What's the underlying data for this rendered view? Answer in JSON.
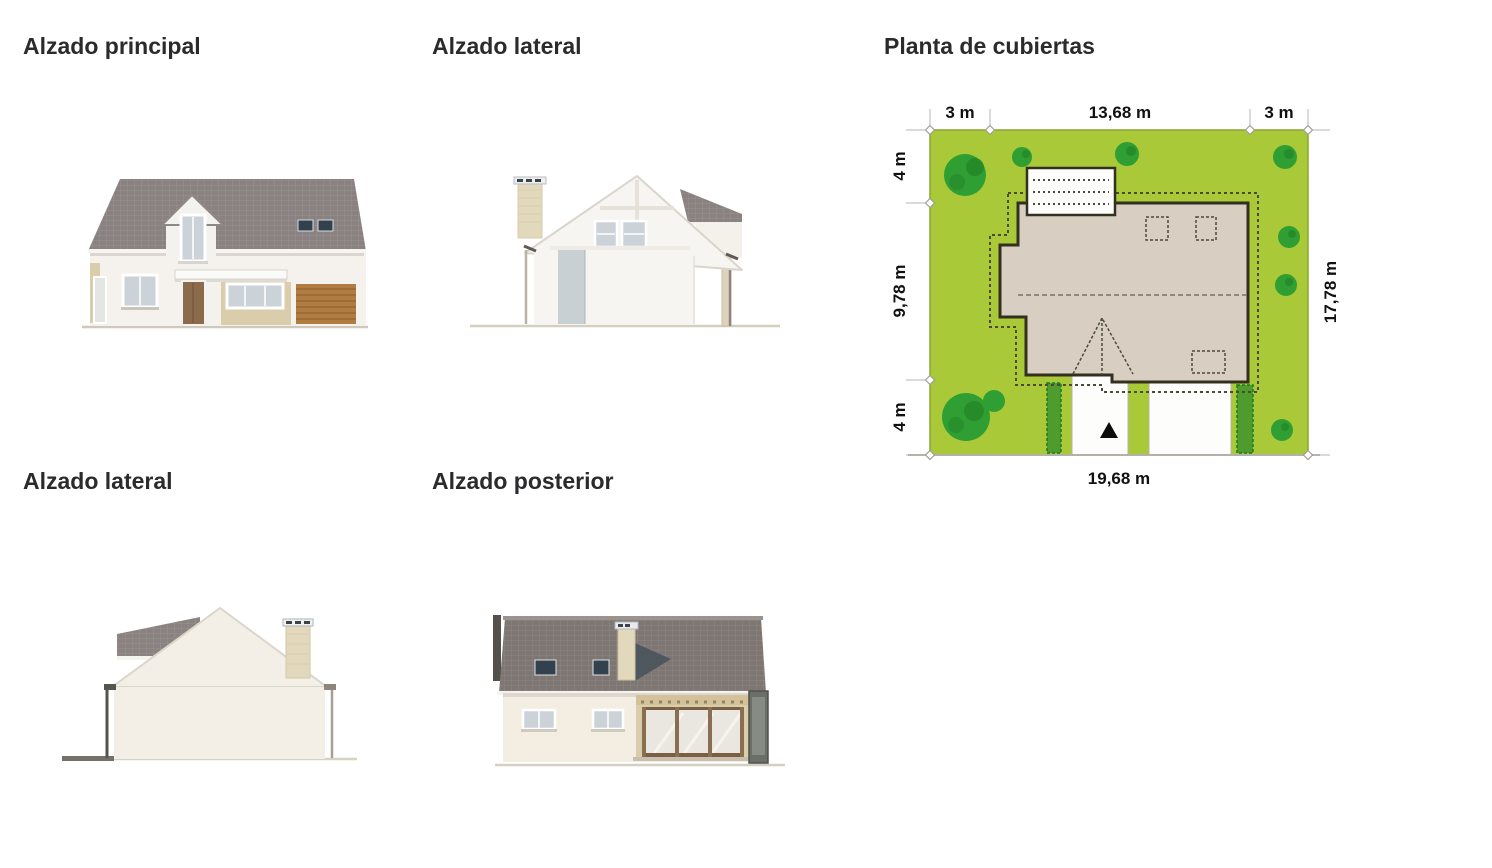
{
  "colors": {
    "heading": "#2b2b2e",
    "lot": "#a9c938",
    "tree": "#2f9e33",
    "treeDark": "#1d7a22",
    "hedge": "#4f9c2e",
    "roofPlanFill": "#d8cec2",
    "roofPlanLine": "#33301f",
    "dashLine": "#4c4a36",
    "dimText": "#111111",
    "roofTile": "#8a8280",
    "roofTileRear": "#7e7672",
    "wall": "#f5f2ed",
    "wallCream": "#f3efe7",
    "stone": "#d9cdab",
    "glass": "#ccd3d8",
    "doorBrown": "#8c6a4c",
    "garage": "#b07c42",
    "windowDark": "#33414e",
    "chimney": "#e2d8bc",
    "bluePanel": "#c9d0d4",
    "mullion": "#8a6e50"
  },
  "sections": [
    {
      "id": "front",
      "title": "Alzado principal"
    },
    {
      "id": "side_top",
      "title": "Alzado lateral"
    },
    {
      "id": "roof_plan",
      "title": "Planta de cubiertas"
    },
    {
      "id": "side_bottom",
      "title": "Alzado lateral"
    },
    {
      "id": "rear",
      "title": "Alzado posterior"
    }
  ],
  "roof_plan": {
    "dimensions": {
      "top": [
        "3 m",
        "13,68 m",
        "3 m"
      ],
      "left": [
        "4 m",
        "9,78 m",
        "4 m"
      ],
      "right": "17,78 m",
      "bottom": "19,68 m"
    }
  }
}
